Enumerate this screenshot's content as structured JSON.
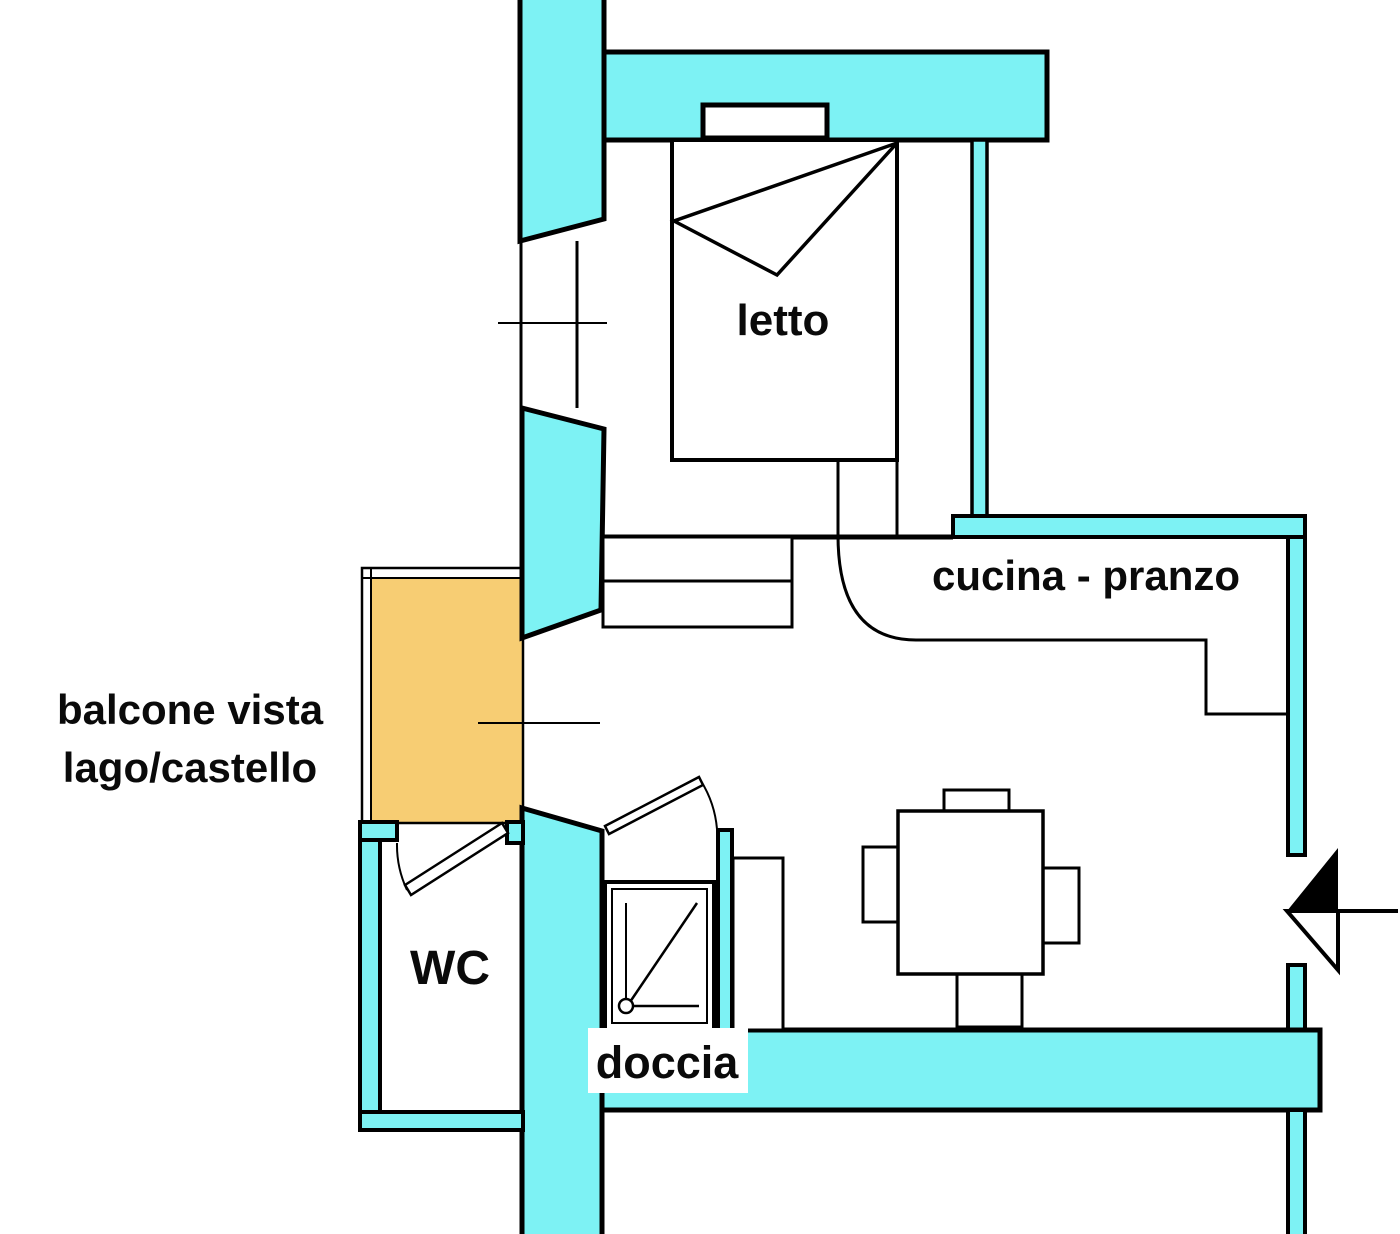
{
  "title": "floor plan - monolocale",
  "colors": {
    "wall": "#7df2f4",
    "balcony": "#f7cd73",
    "line": "#000000",
    "text": "#0a0a0a",
    "background": "#ffffff"
  },
  "rooms": {
    "bedroom_label": "letto",
    "kitchen_label": "cucina - pranzo",
    "balcony_label_line1": "balcone vista",
    "balcony_label_line2": "lago/castello",
    "wc_label": "WC",
    "shower_label": "doccia"
  }
}
